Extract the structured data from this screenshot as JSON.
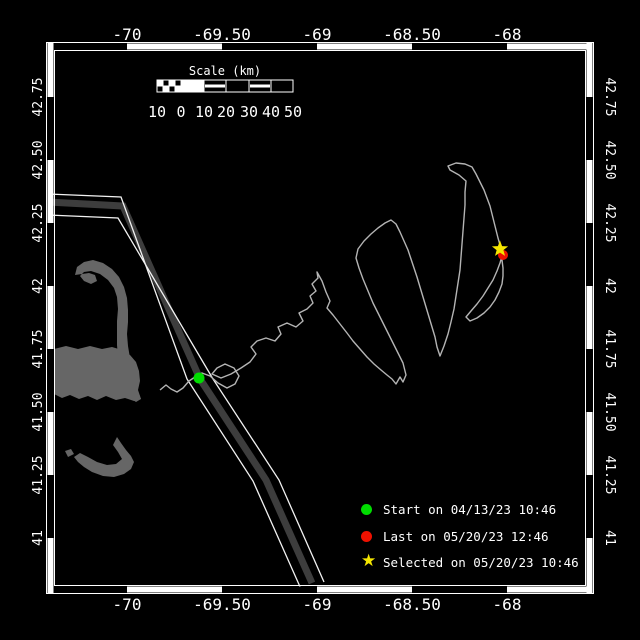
{
  "canvas": {
    "width": 640,
    "height": 640,
    "bg": "#000000"
  },
  "colors": {
    "frame_line": "#ffffff",
    "band_black": "#000000",
    "band_white": "#ffffff",
    "land": "#666666",
    "lane_band": "#3d3d3d",
    "lane_edge": "#f2f2f2",
    "track": "#b4b4b4",
    "start_green": "#00dd00",
    "last_red": "#ee1100",
    "selected_yellow": "#f5e600",
    "text": "#ffffff"
  },
  "axes": {
    "top_ticks": [
      {
        "label": "-70",
        "x": 127
      },
      {
        "label": "-69.50",
        "x": 222
      },
      {
        "label": "-69",
        "x": 317
      },
      {
        "label": "-68.50",
        "x": 412
      },
      {
        "label": "-68",
        "x": 507
      }
    ],
    "bottom_ticks": [
      {
        "label": "-70",
        "x": 127
      },
      {
        "label": "-69.50",
        "x": 222
      },
      {
        "label": "-69",
        "x": 317
      },
      {
        "label": "-68.50",
        "x": 412
      },
      {
        "label": "-68",
        "x": 507
      }
    ],
    "left_ticks": [
      {
        "label": "42.75",
        "y": 97
      },
      {
        "label": "42.50",
        "y": 160
      },
      {
        "label": "42.25",
        "y": 223
      },
      {
        "label": "42",
        "y": 286
      },
      {
        "label": "41.75",
        "y": 349
      },
      {
        "label": "41.50",
        "y": 412
      },
      {
        "label": "41.25",
        "y": 475
      },
      {
        "label": "41",
        "y": 538
      }
    ],
    "right_ticks": [
      {
        "label": "42.75",
        "y": 97
      },
      {
        "label": "42.50",
        "y": 160
      },
      {
        "label": "42.25",
        "y": 223
      },
      {
        "label": "42",
        "y": 286
      },
      {
        "label": "41.75",
        "y": 349
      },
      {
        "label": "41.50",
        "y": 412
      },
      {
        "label": "41.25",
        "y": 475
      },
      {
        "label": "41",
        "y": 538
      }
    ]
  },
  "frame": {
    "outer": [
      46.5,
      42.5,
      547,
      551
    ],
    "inner": [
      54.5,
      50.5,
      531,
      535
    ],
    "band": 6,
    "lon_bounds": [
      48,
      127,
      222,
      317,
      412,
      507,
      592
    ],
    "lat_bounds": [
      43,
      97,
      160,
      223,
      286,
      349,
      412,
      475,
      538,
      593
    ],
    "top_first": "black",
    "side_first": "white"
  },
  "scalebar": {
    "title": "Scale (km)",
    "title_x": 225,
    "title_y": 75,
    "y": 80,
    "h": 12,
    "bounds": [
      157,
      181,
      204,
      226,
      249,
      271,
      293
    ],
    "segment_styles": [
      "checker",
      "solid",
      "stripe",
      "empty",
      "stripe",
      "empty"
    ],
    "labels": [
      "10",
      "0",
      "10",
      "20",
      "30",
      "40",
      "50"
    ],
    "label_y": 117
  },
  "legend": {
    "items": [
      {
        "marker": "circle",
        "color": "#00dd00",
        "label": "Start on 04/13/23 10:46"
      },
      {
        "marker": "circle",
        "color": "#ee1100",
        "label": "Last on 05/20/23 12:46"
      },
      {
        "marker": "star",
        "color": "#f5e600",
        "label": "Selected on 05/20/23 10:46"
      }
    ],
    "row_tops": [
      501,
      528,
      554
    ]
  },
  "map": {
    "markers": [
      {
        "name": "start-marker",
        "shape": "circle",
        "x": 199,
        "y": 378,
        "r": 5.5,
        "color": "#00dd00"
      },
      {
        "name": "last-marker",
        "shape": "circle",
        "x": 503,
        "y": 255,
        "r": 5,
        "color": "#ee1100"
      },
      {
        "name": "selected-marker",
        "shape": "star",
        "x": 500,
        "y": 249,
        "r": 8.5,
        "color": "#f5e600"
      }
    ],
    "lane": {
      "center": [
        [
          48,
          202
        ],
        [
          123,
          206
        ],
        [
          200,
          379
        ],
        [
          266,
          480
        ],
        [
          312,
          583
        ]
      ],
      "edge_left": [
        [
          48,
          194
        ],
        [
          121,
          197
        ],
        [
          187,
          379
        ],
        [
          253,
          481
        ],
        [
          301,
          589
        ]
      ],
      "edge_right": [
        [
          48,
          215
        ],
        [
          118,
          218
        ],
        [
          213,
          379
        ],
        [
          279,
          480
        ],
        [
          324,
          582
        ]
      ]
    },
    "land": {
      "cape_hook_forearm": [
        [
          75,
          275
        ],
        [
          77,
          267
        ],
        [
          84,
          262
        ],
        [
          93,
          260
        ],
        [
          103,
          263
        ],
        [
          112,
          269
        ],
        [
          119,
          277
        ],
        [
          124,
          287
        ],
        [
          127,
          298
        ],
        [
          128,
          310
        ],
        [
          128,
          322
        ],
        [
          127,
          334
        ],
        [
          128,
          346
        ],
        [
          130,
          358
        ],
        [
          132,
          370
        ],
        [
          135,
          381
        ],
        [
          138,
          391
        ],
        [
          141,
          399
        ],
        [
          136,
          402
        ],
        [
          130,
          398
        ],
        [
          126,
          390
        ],
        [
          123,
          380
        ],
        [
          120,
          369
        ],
        [
          118,
          357
        ],
        [
          117,
          345
        ],
        [
          117,
          333
        ],
        [
          117,
          321
        ],
        [
          118,
          309
        ],
        [
          117,
          297
        ],
        [
          114,
          288
        ],
        [
          108,
          280
        ],
        [
          100,
          274
        ],
        [
          91,
          271
        ],
        [
          84,
          272
        ],
        [
          80,
          276
        ],
        [
          84,
          281
        ],
        [
          91,
          284
        ],
        [
          97,
          281
        ],
        [
          95,
          275
        ],
        [
          89,
          273
        ]
      ],
      "cape_arm": [
        [
          54,
          349
        ],
        [
          66,
          346
        ],
        [
          78,
          349
        ],
        [
          90,
          346
        ],
        [
          102,
          349
        ],
        [
          112,
          347
        ],
        [
          122,
          350
        ],
        [
          130,
          355
        ],
        [
          136,
          362
        ],
        [
          139,
          371
        ],
        [
          140,
          381
        ],
        [
          138,
          390
        ],
        [
          141,
          399
        ],
        [
          134,
          401
        ],
        [
          125,
          398
        ],
        [
          116,
          400
        ],
        [
          106,
          396
        ],
        [
          97,
          400
        ],
        [
          88,
          396
        ],
        [
          79,
          399
        ],
        [
          70,
          395
        ],
        [
          62,
          398
        ],
        [
          54,
          394
        ]
      ],
      "nantucket": [
        [
          117,
          437
        ],
        [
          121,
          443
        ],
        [
          126,
          450
        ],
        [
          131,
          456
        ],
        [
          134,
          462
        ],
        [
          131,
          469
        ],
        [
          124,
          474
        ],
        [
          114,
          477
        ],
        [
          103,
          476
        ],
        [
          92,
          472
        ],
        [
          84,
          467
        ],
        [
          78,
          462
        ],
        [
          74,
          457
        ],
        [
          80,
          453
        ],
        [
          88,
          457
        ],
        [
          97,
          462
        ],
        [
          107,
          465
        ],
        [
          116,
          464
        ],
        [
          122,
          459
        ],
        [
          118,
          452
        ],
        [
          113,
          445
        ]
      ],
      "islet": [
        [
          65,
          451
        ],
        [
          71,
          449
        ],
        [
          74,
          454
        ],
        [
          68,
          457
        ]
      ]
    },
    "track": [
      [
        160,
        390
      ],
      [
        166,
        385
      ],
      [
        171,
        389
      ],
      [
        177,
        392
      ],
      [
        183,
        388
      ],
      [
        189,
        381
      ],
      [
        195,
        377
      ],
      [
        202,
        373
      ],
      [
        210,
        376
      ],
      [
        218,
        383
      ],
      [
        227,
        388
      ],
      [
        235,
        384
      ],
      [
        239,
        376
      ],
      [
        234,
        368
      ],
      [
        225,
        364
      ],
      [
        217,
        368
      ],
      [
        212,
        374
      ],
      [
        221,
        378
      ],
      [
        231,
        374
      ],
      [
        241,
        368
      ],
      [
        250,
        362
      ],
      [
        256,
        354
      ],
      [
        251,
        347
      ],
      [
        257,
        341
      ],
      [
        266,
        338
      ],
      [
        275,
        341
      ],
      [
        281,
        334
      ],
      [
        278,
        327
      ],
      [
        287,
        323
      ],
      [
        296,
        327
      ],
      [
        303,
        321
      ],
      [
        299,
        313
      ],
      [
        307,
        309
      ],
      [
        313,
        303
      ],
      [
        310,
        296
      ],
      [
        316,
        291
      ],
      [
        312,
        284
      ],
      [
        318,
        278
      ],
      [
        317,
        272
      ],
      [
        322,
        281
      ],
      [
        326,
        292
      ],
      [
        330,
        301
      ],
      [
        327,
        308
      ],
      [
        333,
        315
      ],
      [
        340,
        324
      ],
      [
        347,
        333
      ],
      [
        353,
        341
      ],
      [
        360,
        349
      ],
      [
        367,
        357
      ],
      [
        374,
        364
      ],
      [
        381,
        370
      ],
      [
        387,
        375
      ],
      [
        392,
        379
      ],
      [
        396,
        384
      ],
      [
        400,
        377
      ],
      [
        403,
        382
      ],
      [
        406,
        375
      ],
      [
        403,
        363
      ],
      [
        397,
        351
      ],
      [
        391,
        339
      ],
      [
        385,
        327
      ],
      [
        379,
        315
      ],
      [
        373,
        303
      ],
      [
        368,
        291
      ],
      [
        363,
        279
      ],
      [
        359,
        268
      ],
      [
        356,
        258
      ],
      [
        358,
        249
      ],
      [
        364,
        241
      ],
      [
        371,
        234
      ],
      [
        378,
        228
      ],
      [
        385,
        223
      ],
      [
        391,
        220
      ],
      [
        396,
        224
      ],
      [
        400,
        232
      ],
      [
        404,
        241
      ],
      [
        408,
        250
      ],
      [
        411,
        259
      ],
      [
        414,
        268
      ],
      [
        417,
        277
      ],
      [
        420,
        287
      ],
      [
        423,
        297
      ],
      [
        426,
        307
      ],
      [
        429,
        317
      ],
      [
        432,
        327
      ],
      [
        435,
        337
      ],
      [
        437,
        347
      ],
      [
        440,
        356
      ],
      [
        444,
        346
      ],
      [
        448,
        334
      ],
      [
        451,
        322
      ],
      [
        454,
        309
      ],
      [
        456,
        296
      ],
      [
        458,
        283
      ],
      [
        460,
        270
      ],
      [
        461,
        257
      ],
      [
        462,
        244
      ],
      [
        463,
        231
      ],
      [
        464,
        218
      ],
      [
        465,
        205
      ],
      [
        465,
        192
      ],
      [
        466,
        181
      ],
      [
        459,
        175
      ],
      [
        450,
        170
      ],
      [
        448,
        166
      ],
      [
        456,
        163
      ],
      [
        465,
        164
      ],
      [
        472,
        167
      ],
      [
        476,
        174
      ],
      [
        480,
        182
      ],
      [
        484,
        190
      ],
      [
        487,
        198
      ],
      [
        490,
        206
      ],
      [
        492,
        214
      ],
      [
        494,
        222
      ],
      [
        496,
        230
      ],
      [
        498,
        238
      ],
      [
        500,
        245
      ],
      [
        501,
        252
      ],
      [
        502,
        260
      ],
      [
        503,
        268
      ],
      [
        503,
        276
      ],
      [
        502,
        284
      ],
      [
        499,
        292
      ],
      [
        495,
        300
      ],
      [
        490,
        307
      ],
      [
        484,
        313
      ],
      [
        477,
        318
      ],
      [
        470,
        321
      ],
      [
        466,
        317
      ],
      [
        471,
        311
      ],
      [
        477,
        304
      ],
      [
        483,
        296
      ],
      [
        488,
        288
      ],
      [
        493,
        280
      ],
      [
        497,
        271
      ],
      [
        500,
        263
      ],
      [
        502,
        256
      ]
    ]
  },
  "chart_data": {
    "type": "line",
    "title": "",
    "xlabel": "Longitude (deg)",
    "ylabel": "Latitude (deg)",
    "xlim": [
      -70.42,
      -67.55
    ],
    "ylim": [
      40.78,
      42.96
    ],
    "x_ticks": [
      -70,
      -69.5,
      -69,
      -68.5,
      -68
    ],
    "y_ticks": [
      42.75,
      42.5,
      42.25,
      42,
      41.75,
      41.5,
      41.25,
      41
    ],
    "grid": false,
    "legend_position": "lower right",
    "series": [
      {
        "name": "vehicle-track",
        "approx_points_lon_lat": [
          [
            -69.83,
            41.59
          ],
          [
            -69.63,
            41.64
          ],
          [
            -69.0,
            42.06
          ],
          [
            -68.56,
            41.63
          ],
          [
            -68.61,
            42.26
          ],
          [
            -68.37,
            41.75
          ],
          [
            -68.22,
            42.46
          ],
          [
            -67.97,
            42.12
          ]
        ]
      }
    ],
    "markers": [
      {
        "name": "Start",
        "lon": -69.63,
        "lat": 41.64,
        "label": "Start on 04/13/23 10:46",
        "color": "green"
      },
      {
        "name": "Last",
        "lon": -67.97,
        "lat": 42.12,
        "label": "Last on 05/20/23 12:46",
        "color": "red"
      },
      {
        "name": "Selected",
        "lon": -67.99,
        "lat": 42.13,
        "label": "Selected on 05/20/23 10:46",
        "color": "yellow"
      }
    ],
    "scalebar_km": [
      10,
      0,
      10,
      20,
      30,
      40,
      50
    ],
    "annotations": [
      "Cape Cod and Nantucket landmasses in gray",
      "dark shipping-lane band crossing map diagonally"
    ]
  }
}
